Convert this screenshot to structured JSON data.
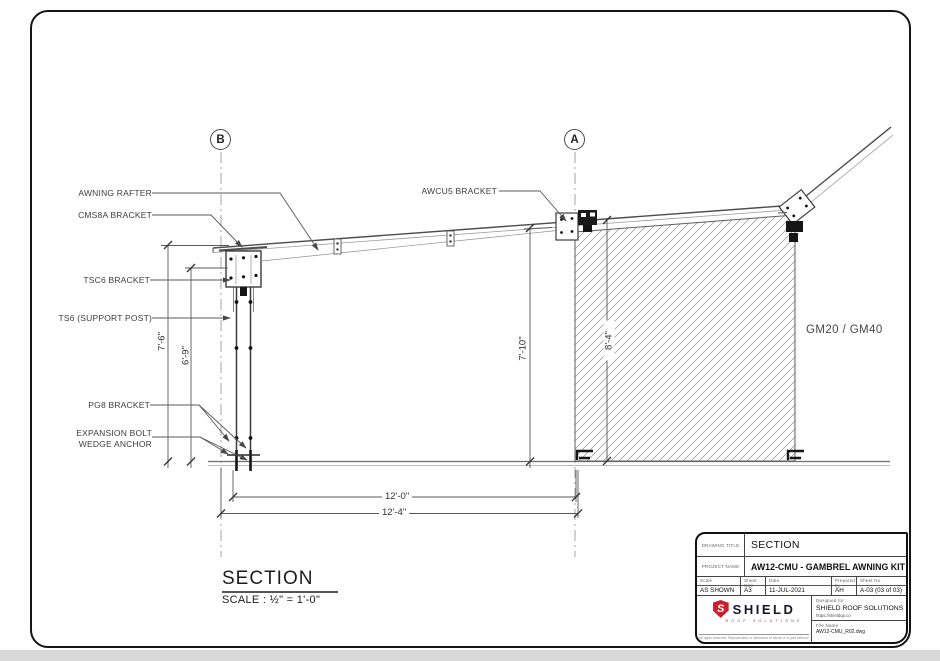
{
  "colors": {
    "accent_red": "#c8202f",
    "line_dark": "#444444",
    "hatch_gray": "#909090"
  },
  "grid_markers": {
    "left": "B",
    "right": "A"
  },
  "labels": {
    "awning_rafter": "AWNING RAFTER",
    "cms8a": "CMS8A BRACKET",
    "tsc6": "TSC6 BRACKET",
    "ts6": "TS6 (SUPPORT POST)",
    "pg8": "PG8 BRACKET",
    "expansion_line1": "EXPANSION BOLT",
    "expansion_line2": "WEDGE ANCHOR",
    "awcu5": "AWCU5 BRACKET",
    "material": "GM20 / GM40"
  },
  "dimensions": {
    "post_height": "7'-6\"",
    "post_clear": "6'-9\"",
    "wall_front": "7'-10\"",
    "wall_height": "8'-4\"",
    "span_clear": "12'-0\"",
    "span_overall": "12'-4\""
  },
  "view": {
    "title": "SECTION",
    "scale": "SCALE : ½\" = 1'-0\""
  },
  "title_block": {
    "drawing_title_label": "DRAWING TITLE",
    "drawing_title": "SECTION",
    "project_name_label": "PROJECT NAME",
    "project_name": "AW12-CMU - GAMBREL AWNING KIT",
    "fields": [
      {
        "label": "Scale",
        "value": "AS SHOWN"
      },
      {
        "label": "Sheet Size",
        "value": "A3"
      },
      {
        "label": "Date",
        "value": "11-JUL-2021"
      },
      {
        "label": "Prepared by",
        "value": "AH"
      },
      {
        "label": "Sheet No.",
        "value": "A-03 (03 of 03)"
      }
    ],
    "logo": {
      "initial": "S",
      "brand": "SHIELD",
      "tagline": "ROOF SOLUTIONS",
      "fine_print": "All rights reserved. Reproduction or disclosure in whole or in part without written consent is prohibited."
    },
    "designed_for_label": "Designed for :",
    "designed_for": "SHIELD ROOF SOLUTIONS",
    "website": "https://shieldup.co",
    "file_name_label": "File Name :",
    "file_name": "AW12-CMU_R02.dwg"
  }
}
